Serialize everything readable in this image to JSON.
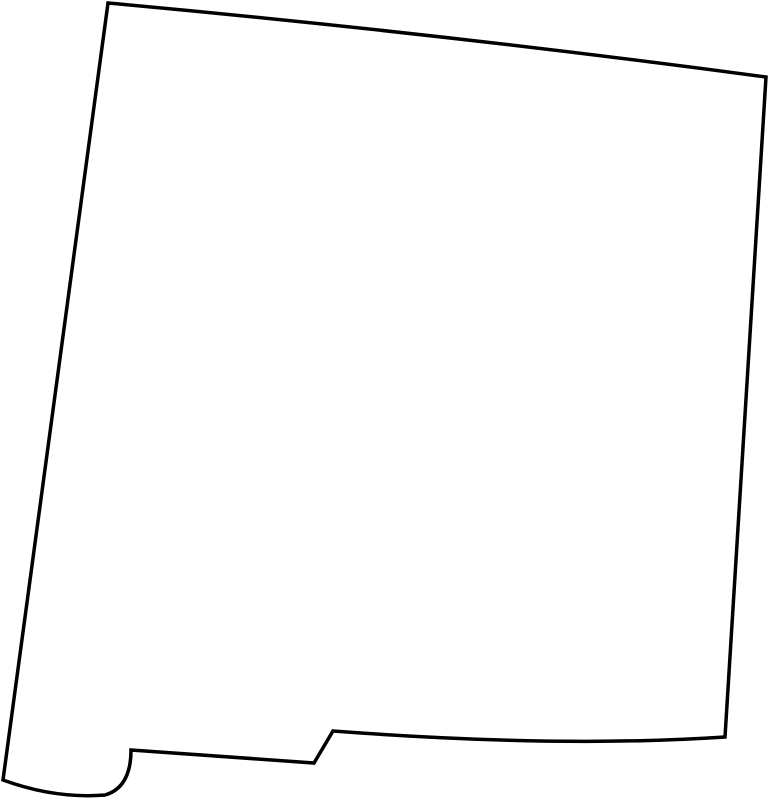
{
  "map": {
    "region_name": "New Mexico",
    "map_kind": "blank-state-outline-map",
    "outline_path": "M 108 3 Q 437 33 766 77 L 725 737 Q 560 748 333 731 L 314 763 L 131 750 C 131 775 122 790 105 795 Q 55 799 3 780 Z",
    "viewbox": "0 0 769 800",
    "stroke_color": "#000000",
    "fill_color": "#ffffff",
    "background_color": "#ffffff",
    "stroke_width": "3.5"
  }
}
